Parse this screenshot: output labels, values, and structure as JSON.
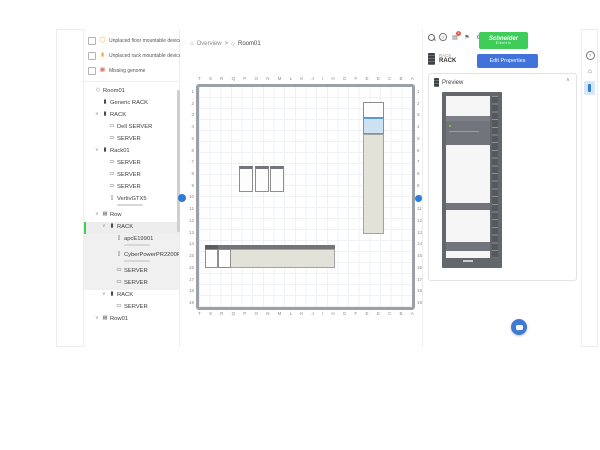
{
  "header": {
    "breadcrumb": {
      "section": "Overview",
      "separator": ">",
      "page": "Room01"
    },
    "logo": {
      "line1": "Schneider",
      "line2": "Electric"
    },
    "notification_badge": "1"
  },
  "toolbar": {
    "tools": [
      {
        "name": "select-tool",
        "glyph": "⇖",
        "cls": "active"
      },
      {
        "name": "pan-tool",
        "glyph": "✥",
        "cls": ""
      },
      {
        "name": "add-tool",
        "glyph": "",
        "cls": "dot"
      },
      {
        "name": "measure-tool",
        "glyph": "⤢",
        "cls": ""
      },
      {
        "name": "annotate-tool",
        "glyph": "A",
        "cls": ""
      },
      {
        "name": "zoom-in-tool",
        "glyph": "⊕",
        "cls": ""
      },
      {
        "name": "zoom-out-tool",
        "glyph": "⊖",
        "cls": ""
      },
      {
        "name": "zoom-fit-tool",
        "glyph": "⊡",
        "cls": ""
      },
      {
        "name": "history-tool",
        "glyph": "↺",
        "cls": ""
      }
    ]
  },
  "filters": [
    {
      "label": "Unplaced floor mountable devices",
      "icon": "floor"
    },
    {
      "label": "Unplaced rack mountable devices",
      "icon": "rackw"
    },
    {
      "label": "Missing genome",
      "icon": "genome"
    }
  ],
  "tree": {
    "items": [
      {
        "level": 0,
        "icon": "room",
        "chev": "",
        "label": "Room01",
        "cls": ""
      },
      {
        "level": 1,
        "icon": "rack",
        "chev": "",
        "label": "Generic RACK",
        "cls": ""
      },
      {
        "level": 1,
        "icon": "rack",
        "chev": "∨",
        "label": "RACK",
        "cls": ""
      },
      {
        "level": 2,
        "icon": "server",
        "chev": "",
        "label": "Dell SERVER",
        "cls": ""
      },
      {
        "level": 2,
        "icon": "server",
        "chev": "",
        "label": "SERVER",
        "cls": ""
      },
      {
        "level": 1,
        "icon": "rack",
        "chev": "∨",
        "label": "Rack01",
        "cls": ""
      },
      {
        "level": 2,
        "icon": "server",
        "chev": "",
        "label": "SERVER",
        "cls": ""
      },
      {
        "level": 2,
        "icon": "server",
        "chev": "",
        "label": "SERVER",
        "cls": ""
      },
      {
        "level": 2,
        "icon": "server",
        "chev": "",
        "label": "SERVER",
        "cls": ""
      },
      {
        "level": 2,
        "icon": "ups",
        "chev": "",
        "label": "VertivGTX5",
        "cls": "has-sub"
      },
      {
        "level": 1,
        "icon": "row",
        "chev": "∨",
        "label": "Row",
        "cls": ""
      },
      {
        "level": 2,
        "icon": "rack",
        "chev": "∨",
        "label": "RACK",
        "cls": "sel"
      },
      {
        "level": 3,
        "icon": "ups",
        "chev": "",
        "label": "apcE19901",
        "cls": "insel has-sub"
      },
      {
        "level": 3,
        "icon": "ups",
        "chev": "",
        "label": "CyberPowerPR2200R...",
        "cls": "insel has-sub"
      },
      {
        "level": 3,
        "icon": "server",
        "chev": "",
        "label": "SERVER",
        "cls": "insel"
      },
      {
        "level": 3,
        "icon": "server",
        "chev": "",
        "label": "SERVER",
        "cls": "insel"
      },
      {
        "level": 2,
        "icon": "rack",
        "chev": "∨",
        "label": "RACK",
        "cls": ""
      },
      {
        "level": 3,
        "icon": "server",
        "chev": "",
        "label": "SERVER",
        "cls": ""
      },
      {
        "level": 1,
        "icon": "row",
        "chev": "∨",
        "label": "Row01",
        "cls": ""
      }
    ]
  },
  "canvas": {
    "columns": [
      "T",
      "S",
      "R",
      "Q",
      "P",
      "O",
      "N",
      "M",
      "L",
      "K",
      "J",
      "I",
      "H",
      "G",
      "F",
      "E",
      "D",
      "C",
      "B",
      "A"
    ],
    "rows": [
      "1",
      "2",
      "3",
      "4",
      "5",
      "6",
      "7",
      "8",
      "9",
      "10",
      "11",
      "12",
      "13",
      "14",
      "15",
      "16",
      "17",
      "18",
      "19"
    ]
  },
  "inspector": {
    "type_label": "RACK",
    "name": "RACK",
    "edit_button": "Edit Properties",
    "preview_title": "Preview"
  },
  "colors": {
    "accent_green": "#3dcd58",
    "selection_blue": "#5b9bd5",
    "button_blue": "#4273da",
    "badge_red": "#e2574c"
  }
}
